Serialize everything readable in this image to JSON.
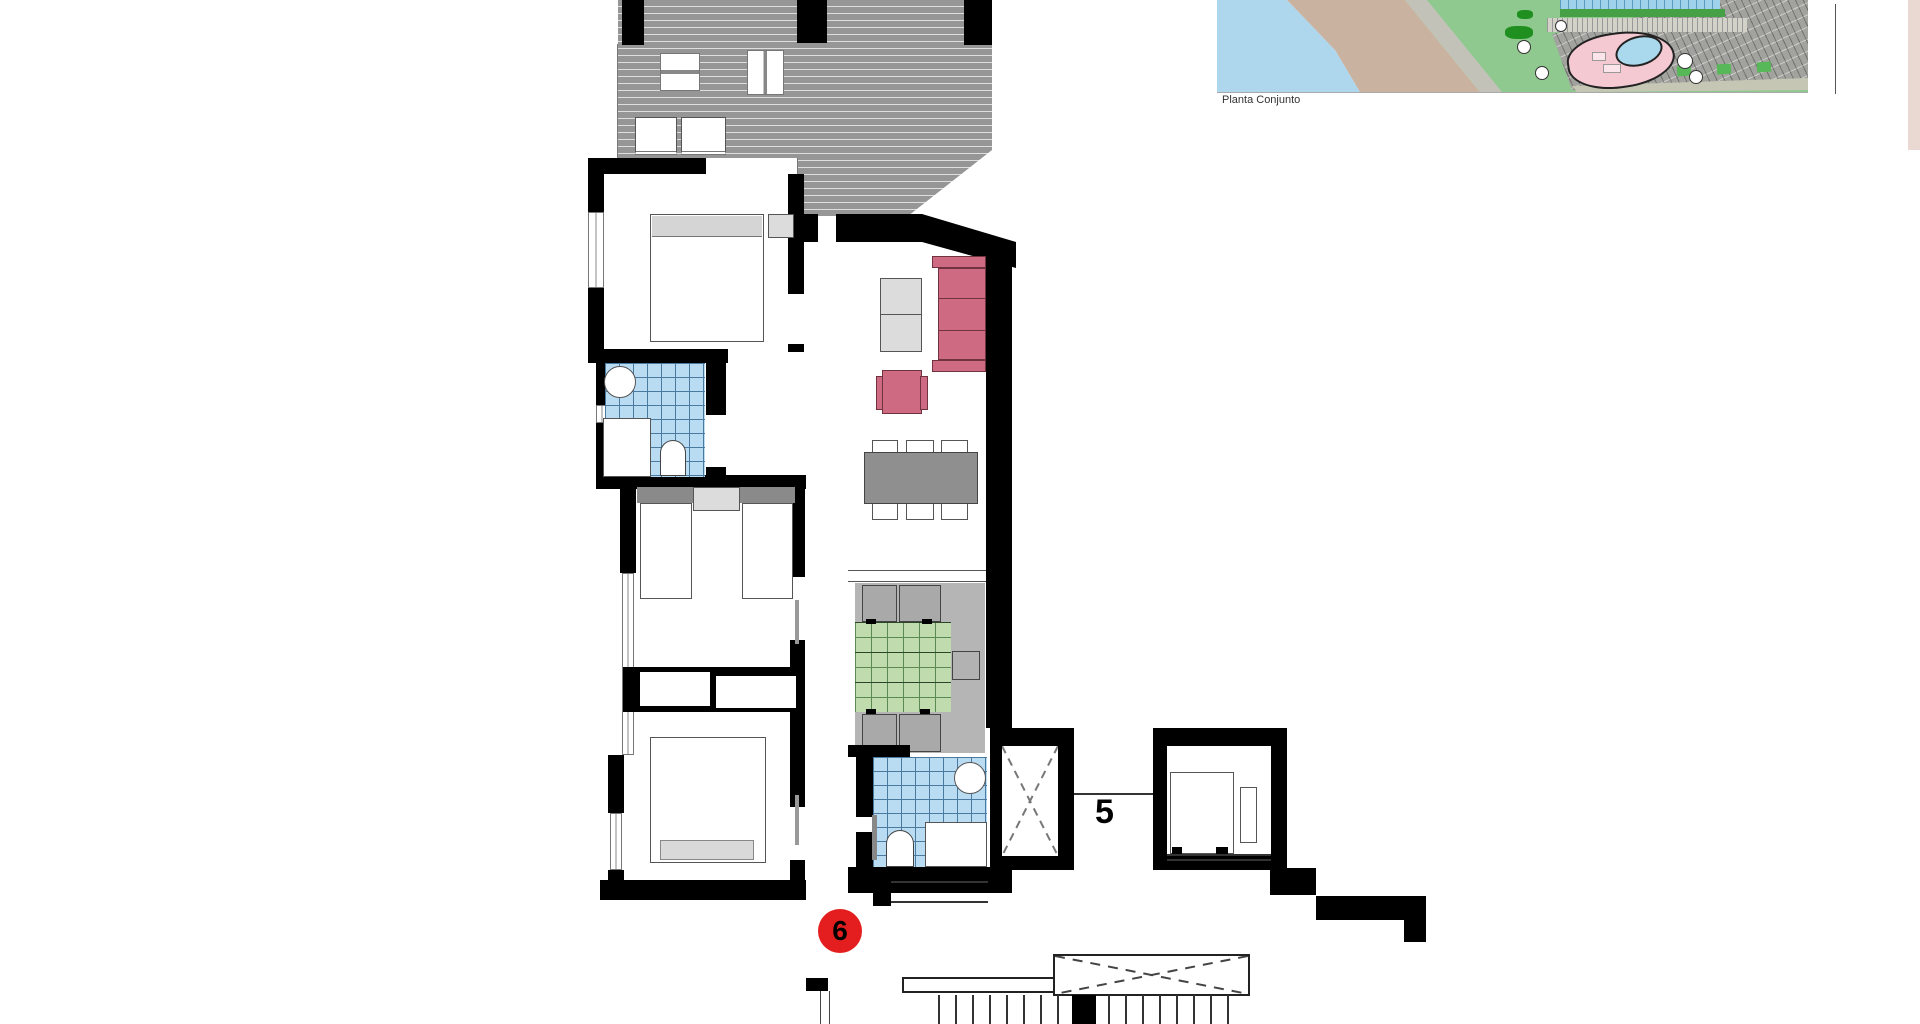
{
  "labels": {
    "site_caption": "Planta Conjunto",
    "unit_5": "5",
    "unit_6": "6"
  },
  "colors": {
    "wall": "#000000",
    "roof_hatch_gray": "#969696",
    "bath_tile_blue": "#badcf2",
    "rug_tile_green": "#c0dcae",
    "sofa_pink": "#ce6b83",
    "dining_table_gray": "#8f8f8f",
    "terrace_gray": "#b5b5b5",
    "unit_badge_red": "#e41e1e",
    "sea_water_blue": "#aed7ee",
    "beach_sand": "#c9b3a0",
    "site_grounds_green": "#8fc98f",
    "pool_deck_pink": "#f4c9d2",
    "pool_water": "#aad8ec",
    "buildings_gray": "#a2a29e"
  }
}
